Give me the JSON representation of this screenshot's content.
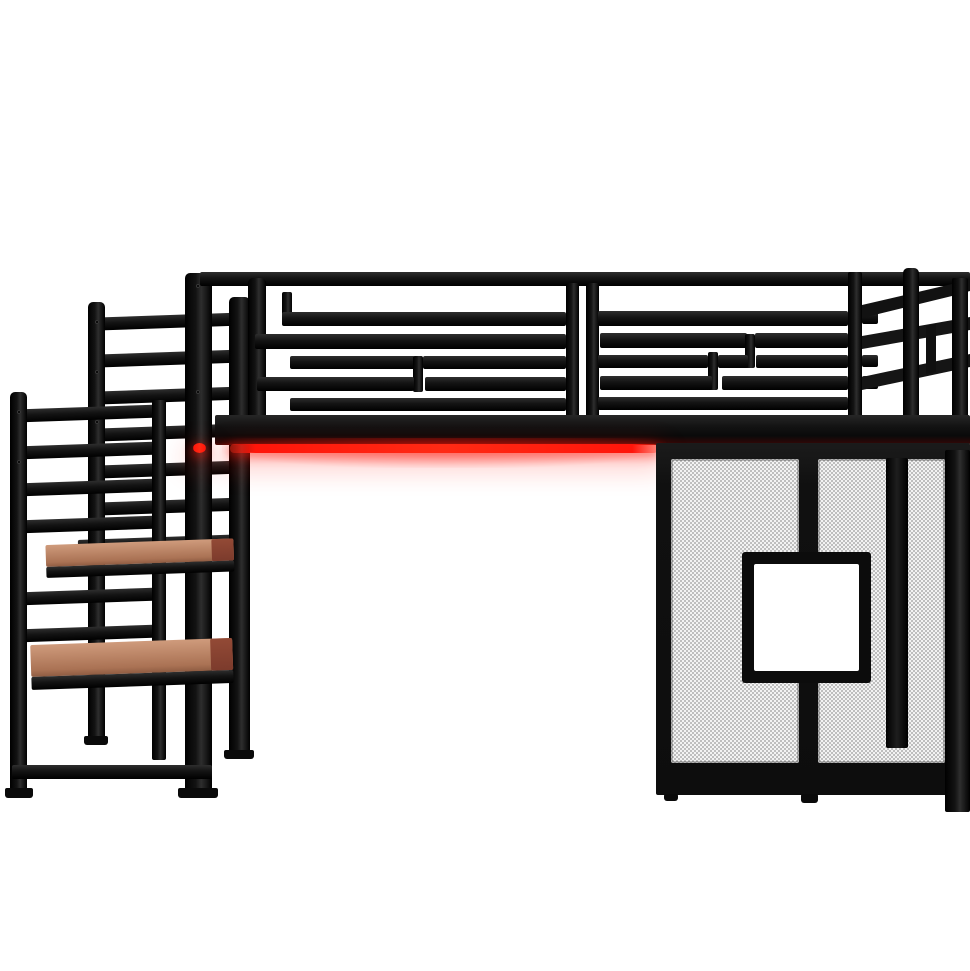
{
  "meta": {
    "alt": "Black metal loft bed with side staircase, wooden steps, red under-bed LED light strip, and mesh privacy panels with a square window, on a plain white studio background"
  },
  "colors": {
    "bg": "#ffffff",
    "frame": "#131313",
    "frame_light": "#2e2e2e",
    "led": "#ff150a",
    "led_glow": "rgba(255,24,12,0.45)",
    "wood_light": "#cf9b7c",
    "wood": "#aa7254",
    "wood_dark": "#7c3b2c",
    "mesh_base": "#f3f3f3",
    "mesh_dot": "#8f8f8f"
  },
  "parts": {
    "scene": "Loft bed product photo",
    "top_rail": "Top guardrail beam",
    "guardrail_left": "Left guardrail section with slat pattern",
    "guardrail_right": "Right guardrail section with slat pattern",
    "end_rail": "Perspective side end rail",
    "platform": "Bed platform beam",
    "led_strip": "Under-bed red LED light strip",
    "mesh_panels": "Lower mesh privacy panels",
    "window": "Square window opening in mesh panel",
    "staircase": "Left staircase with lattice railings",
    "step_upper": "Upper wooden stair tread",
    "step_lower": "Lower wooden stair tread"
  }
}
